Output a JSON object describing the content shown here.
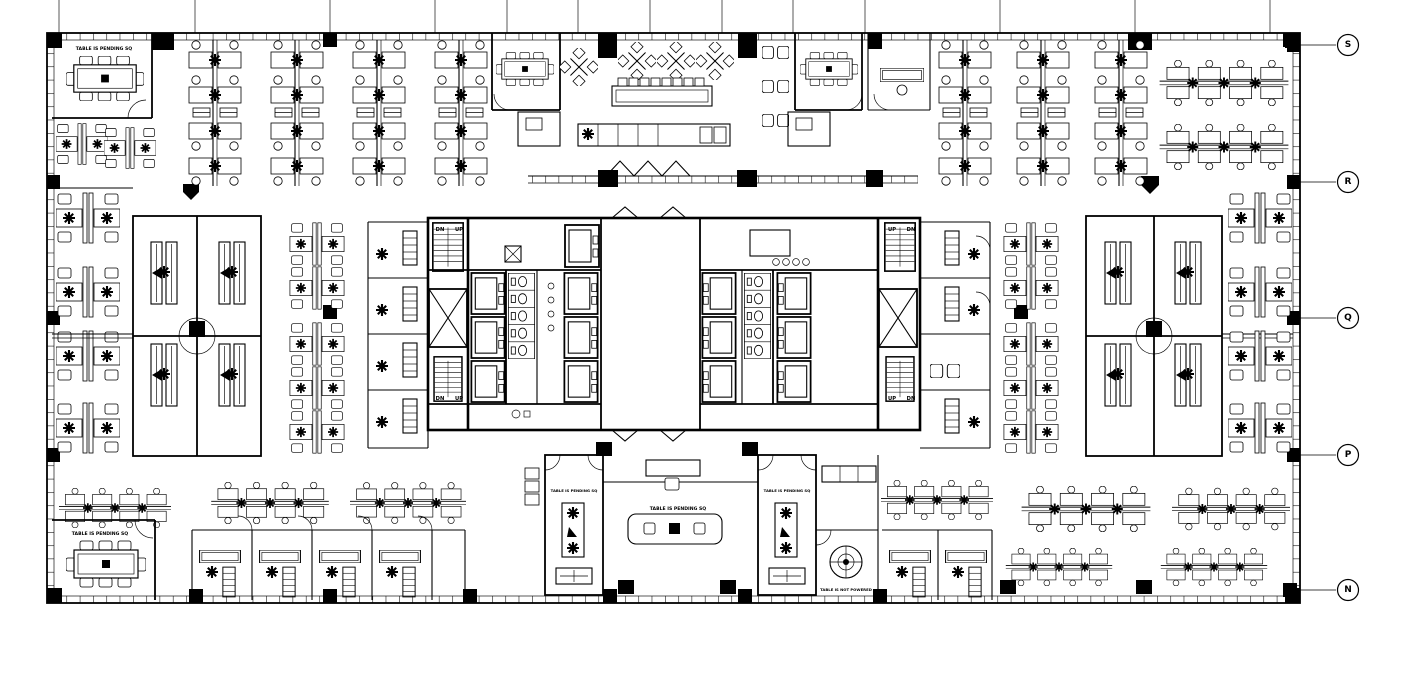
{
  "drawing": {
    "kind": "architectural-floor-plan",
    "line_color": "#000000",
    "background_color": "#ffffff"
  },
  "grid_bubbles": [
    {
      "label": "S"
    },
    {
      "label": "R"
    },
    {
      "label": "Q"
    },
    {
      "label": "P"
    },
    {
      "label": "N"
    }
  ],
  "annotations": {
    "table_pending": "TABLE IS PENDING SQ",
    "table_not_powered": "TABLE IS NOT POWERED",
    "up": "UP",
    "down": "DN"
  }
}
